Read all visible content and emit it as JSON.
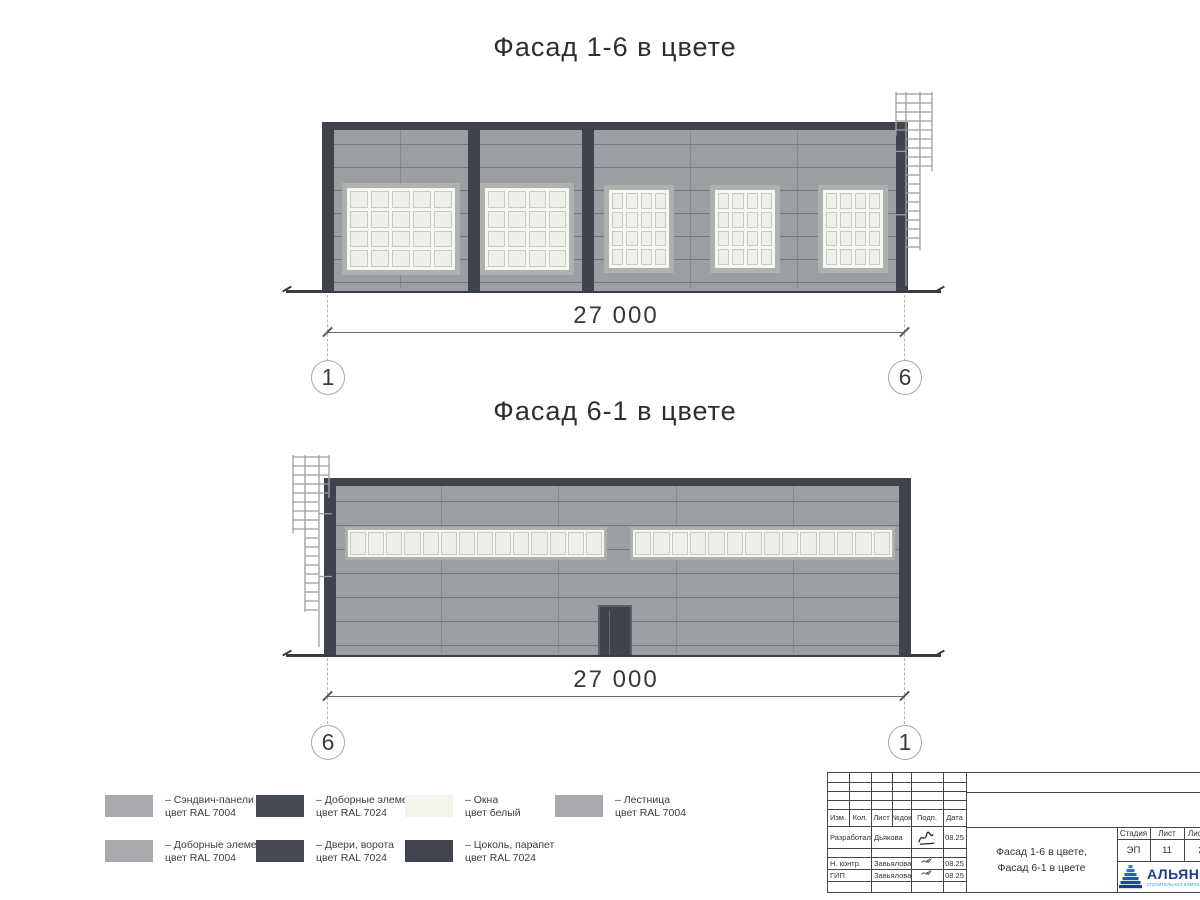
{
  "titles": {
    "top": "Фасад 1-6 в цвете",
    "bottom": "Фасад 6-1 в цвете"
  },
  "dimensions": {
    "top": {
      "value": "27 000",
      "left_bubble": "1",
      "right_bubble": "6"
    },
    "bottom": {
      "value": "27 000",
      "left_bubble": "6",
      "right_bubble": "1"
    }
  },
  "palette": {
    "wall": "#9b9ea2",
    "joint": "#74777b",
    "dark": "#3f444c",
    "window_frame": "#aeb1ad",
    "pane": "#edf0e8",
    "mullion": "#f5f7f1",
    "pane_border": "#c7cac4",
    "ladder": "#9ba0a4",
    "ground": "#3a3d40"
  },
  "legend": {
    "rows": [
      [
        {
          "swatch": "#a7a9ac",
          "line1": "– Сэндвич-панели",
          "line2": "цвет RAL 7004"
        },
        {
          "swatch": "#464b55",
          "line1": "– Доборные элементы",
          "line2": "цвет RAL 7024"
        },
        {
          "swatch": "#f3f4eb",
          "line1": "– Окна",
          "line2": "цвет белый"
        },
        {
          "swatch": "#a7a9ac",
          "line1": "– Лестница",
          "line2": "цвет RAL 7004"
        }
      ],
      [
        {
          "swatch": "#a7a9ac",
          "line1": "– Доборные элементы",
          "line2": "цвет RAL 7004"
        },
        {
          "swatch": "#464b55",
          "line1": "– Двери, ворота",
          "line2": "цвет RAL 7024"
        },
        {
          "swatch": "#3f4450",
          "line1": "– Цоколь, парапет",
          "line2": "цвет RAL 7024"
        }
      ]
    ]
  },
  "title_block": {
    "rev_headers": [
      "Изм.",
      "Кол.",
      "Лист",
      "№док",
      "Подп.",
      "Дата"
    ],
    "sign_rows": [
      {
        "role": "Разработал",
        "name": "Дьякова",
        "date": "08.25"
      },
      {
        "role": "Н. контр.",
        "name": "Завьялова",
        "date": "08.25"
      },
      {
        "role": "ГИП",
        "name": "Завьялова",
        "date": "08.25"
      }
    ],
    "doc_title_line1": "Фасад 1-6 в цвете,",
    "doc_title_line2": "Фасад 6-1 в цвете",
    "stage_header": "Стадия",
    "sheet_header": "Лист",
    "total_header": "Листов",
    "stage": "ЭП",
    "sheet": "11",
    "total": "2",
    "logo_text": "АЛЬЯНС",
    "logo_sub": "строительная компания",
    "logo_blue": "#1e5fae"
  },
  "drawing": {
    "top_facade": {
      "x": 322,
      "y": 122,
      "w": 586,
      "h": 169,
      "parapet_h": 8,
      "joint_step": 23,
      "columns": [
        0,
        146,
        260,
        574
      ],
      "column_w": 12,
      "seams": [
        78,
        368,
        475
      ],
      "windows": [
        {
          "x": 20,
          "y": 61,
          "w": 118,
          "h": 92,
          "cols": 5,
          "rows": 4
        },
        {
          "x": 158,
          "y": 61,
          "w": 94,
          "h": 92,
          "cols": 4,
          "rows": 4
        },
        {
          "x": 282,
          "y": 63,
          "w": 70,
          "h": 88,
          "cols": 4,
          "rows": 4
        },
        {
          "x": 388,
          "y": 63,
          "w": 70,
          "h": 88,
          "cols": 4,
          "rows": 4
        },
        {
          "x": 496,
          "y": 63,
          "w": 70,
          "h": 88,
          "cols": 4,
          "rows": 4
        }
      ],
      "ladder": {
        "x": 893,
        "y": 92,
        "w": 42,
        "h": 198,
        "side": "right"
      },
      "ground": {
        "x1": 286,
        "x2": 941,
        "y": 290
      }
    },
    "bottom_facade": {
      "x": 324,
      "y": 478,
      "w": 587,
      "h": 177,
      "parapet_h": 8,
      "joint_step": 24,
      "columns": [
        0,
        575
      ],
      "column_w": 12,
      "seams": [
        117,
        234,
        352,
        469
      ],
      "windows": [
        {
          "x": 21,
          "y": 49,
          "w": 262,
          "h": 33,
          "cols": 14,
          "rows": 1
        },
        {
          "x": 306,
          "y": 49,
          "w": 265,
          "h": 33,
          "cols": 14,
          "rows": 1
        }
      ],
      "door": {
        "x": 274,
        "y": 127,
        "w": 34,
        "h": 50
      },
      "ladder": {
        "x": 290,
        "y": 455,
        "w": 42,
        "h": 196,
        "side": "left"
      },
      "ground": {
        "x1": 286,
        "x2": 941,
        "y": 654
      }
    }
  }
}
